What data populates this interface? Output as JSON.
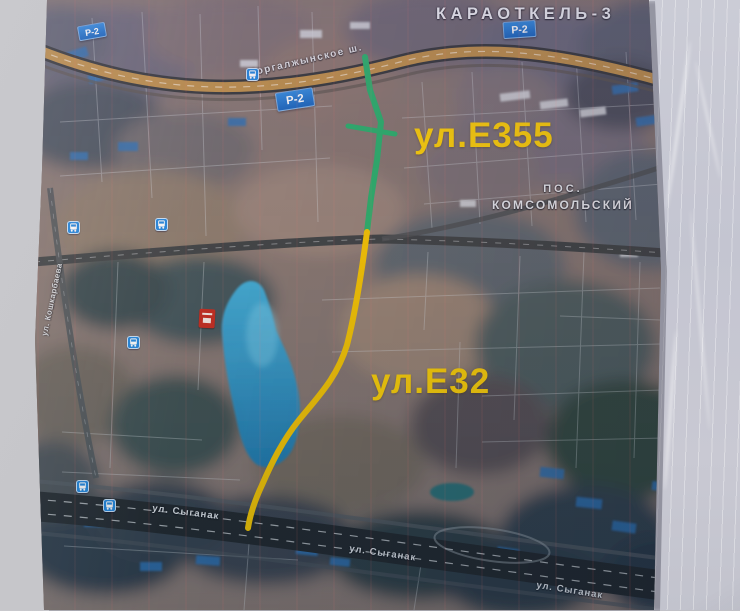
{
  "map": {
    "area_title": "КАРАОТКЕЛЬ-3",
    "settlement": {
      "line1": "ПОС.",
      "line2": "КОМСОМОЛЬСКИЙ"
    },
    "labels": {
      "e355": "ул.Е355",
      "e32": "ул.Е32"
    },
    "road_badge": "Р-2",
    "streets": {
      "highway": "Коргалжынское ш.",
      "syganak": "ул. Сыганак",
      "left_vertical": "ул. Кошкарбаева"
    },
    "routes": [
      {
        "name": "green-route",
        "color": "#27b16c"
      },
      {
        "name": "yellow-route",
        "color": "#f5c500"
      }
    ],
    "colors": {
      "label_yellow": "#ffd204",
      "badge_blue": "#1d72c8",
      "lake_blue": "#2f9cd0",
      "highway_tan": "#bd8f4a"
    },
    "icons": {
      "transit_stop": "transit-stop-icon",
      "red_marker": "red-marker-icon"
    }
  }
}
